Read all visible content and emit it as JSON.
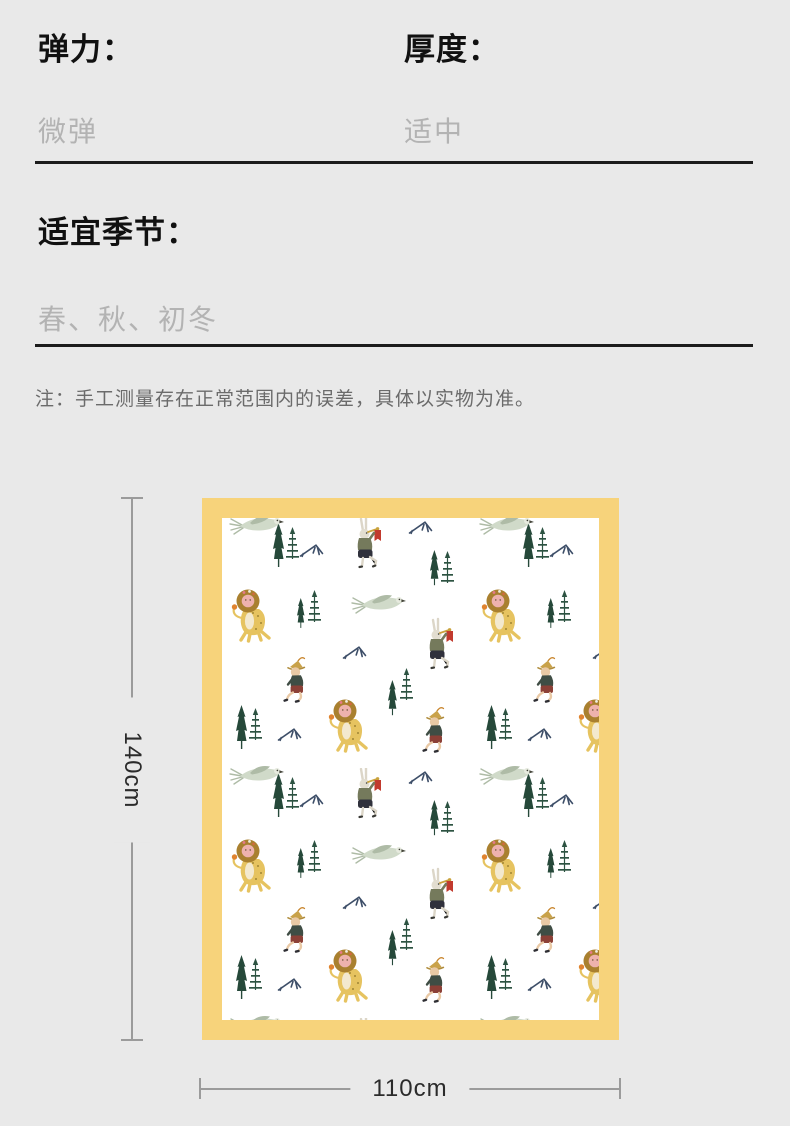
{
  "specs": {
    "items": [
      {
        "label": "弹力：",
        "value": "微弹"
      },
      {
        "label": "厚度：",
        "value": "适中"
      },
      {
        "label": "适宜季节：",
        "value": "春、秋、初冬"
      }
    ]
  },
  "note": "注：手工测量存在正常范围内的误差，具体以实物为准。",
  "diagram": {
    "height_label": "140cm",
    "width_label": "110cm",
    "colors": {
      "page_bg": "#e9e9e9",
      "blanket_border": "#f7d37b",
      "blanket_bg": "#ffffff",
      "dimension_line": "#9b9b9b",
      "divider": "#1c1c1c",
      "pine_green": "#26493a",
      "fir_green": "#2d5342",
      "mountain_blue": "#3d4e68",
      "lion_yellow": "#e6c360",
      "flag_red": "#c23a2e"
    },
    "motifs": [
      "lion",
      "trumpeter-rabbit",
      "running-boy",
      "wild-goose",
      "pine-tree",
      "sparse-fir",
      "mountain-mark"
    ]
  }
}
